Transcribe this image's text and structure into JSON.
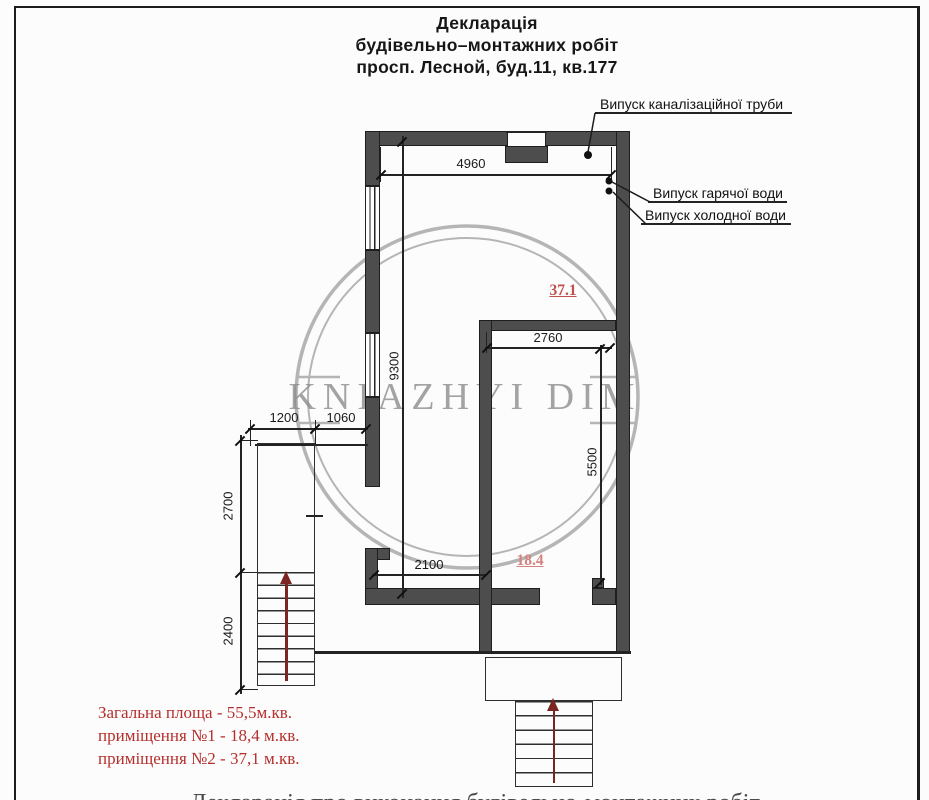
{
  "title": {
    "line1": "Декларація",
    "line2": "будівельно–монтажних робіт",
    "line3": "просп. Лесной, буд.11, кв.177"
  },
  "annotations": {
    "sewer": "Випуск каналізаційної труби",
    "hot_water": "Випуск гарячої води",
    "cold_water": "Випуск холодної води"
  },
  "dimensions": {
    "top_width": "4960",
    "left_height": "9300",
    "inner_width": "2760",
    "inner_height": "5500",
    "stair_width": "1200",
    "entry_width": "1060",
    "upper_left_height": "2700",
    "stair_height": "2400",
    "bottom_width": "2100"
  },
  "room_labels": {
    "room2_area": "37.1",
    "room1_area": "18.4"
  },
  "watermark": {
    "text": "KNIAZHYI DIM",
    "color": "#8d8d8d"
  },
  "legend": {
    "total": "Загальна площа - 55,5м.кв.",
    "room1": "приміщення №1 - 18,4 м.кв.",
    "room2": "приміщення №2 - 37,1 м.кв."
  },
  "bottom_partial_text": "Декларація про виконання будівельно-монтажних робіт",
  "colors": {
    "wall_fill": "#4d4d4d",
    "wall_edge": "#1e1e1e",
    "drawing_line": "#232323",
    "room_label_red": "#c0504d",
    "room_label_red_light": "#d4827e",
    "legend_red": "#b5302d",
    "stair_arrow_red": "#7b2424",
    "watermark_gray": "#9e9e9e"
  }
}
